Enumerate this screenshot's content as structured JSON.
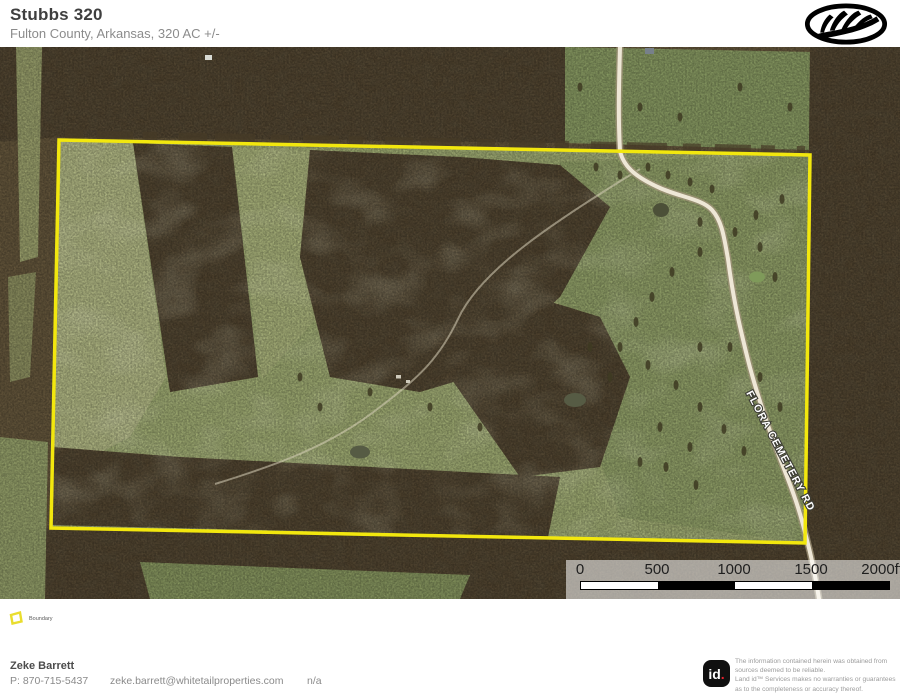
{
  "header": {
    "title": "Stubbs 320",
    "subtitle": "Fulton County, Arkansas, 320 AC +/-"
  },
  "map": {
    "road_label": "FLORA CEMETERY RD",
    "scalebar_labels": [
      "0",
      "500",
      "1000",
      "1500",
      "2000ft"
    ]
  },
  "legend": {
    "items": [
      {
        "label": "Boundary"
      }
    ]
  },
  "footer": {
    "agent_name": "Zeke Barrett",
    "agent_phone": "P: 870-715-5437",
    "agent_email": "zeke.barrett@whitetailproperties.com",
    "agent_extra": "n/a",
    "brand_text": "id",
    "brand_dot": ".",
    "disclaimer_lines": [
      "The information contained herein was obtained from",
      "sources deemed to be reliable.",
      "Land id™ Services makes no warranties or guarantees",
      "as to the completeness or accuracy thereof."
    ]
  },
  "colors": {
    "boundary_yellow": "#f2e70e",
    "brand_red": "#e8212e"
  }
}
